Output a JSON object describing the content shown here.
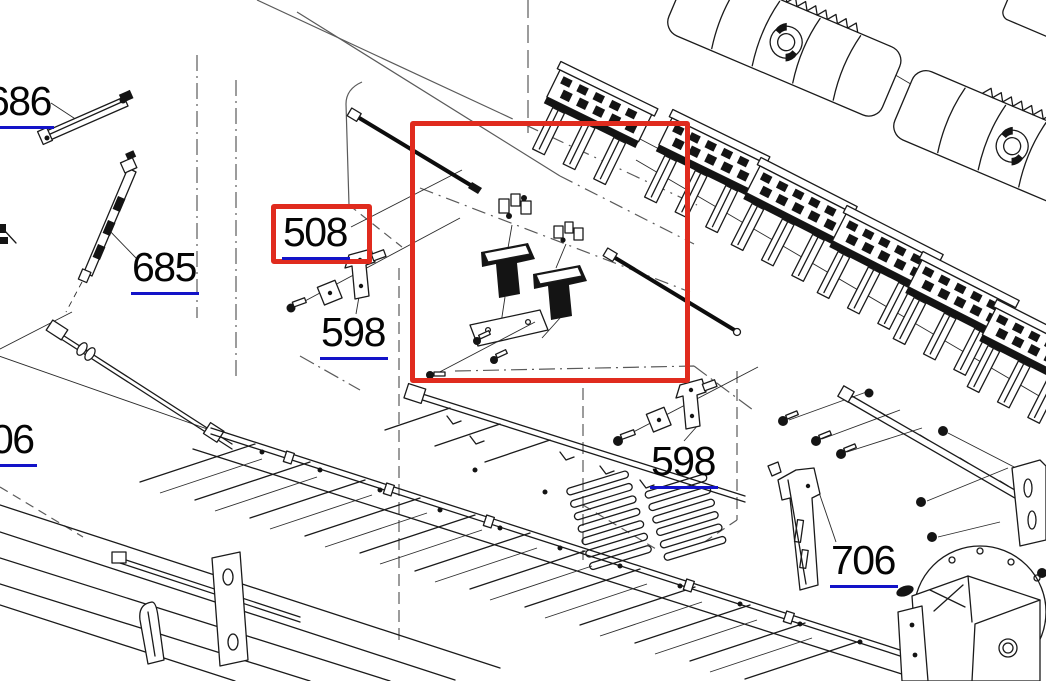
{
  "title": "Printer exploded parts diagram",
  "labels": {
    "l686": {
      "text": "686",
      "underlined": true,
      "clipped_left": true
    },
    "l685": {
      "text": "685",
      "underlined": true
    },
    "l508": {
      "text": "508",
      "underlined": true,
      "boxed": true
    },
    "l598a": {
      "text": "598",
      "underlined": true
    },
    "l06": {
      "text": "06",
      "underlined": true,
      "clipped_left": true
    },
    "l598b": {
      "text": "598",
      "underlined": true
    },
    "l706": {
      "text": "706",
      "underlined": true
    }
  },
  "highlights": {
    "region_box": {
      "x": 410,
      "y": 121,
      "width": 280,
      "height": 262,
      "purpose": "highlighted part region"
    },
    "label_box_508": {
      "x": 271,
      "y": 204,
      "width": 101,
      "height": 60,
      "purpose": "highlighted part number"
    }
  },
  "colors": {
    "background": "#ffffff",
    "line": "#1a1a1a",
    "phantom": "#5a5a5a",
    "highlight_red": "#e02b1e",
    "underline_blue": "#1313c8",
    "label_text": "#050505"
  },
  "drawn_parts": [
    "link-rod-686",
    "telescopic-rod-685",
    "carriage-shaft",
    "clamp-screw-assembly-598-left",
    "clamp-screw-assembly-598-right",
    "rod-and-bracket-group-508",
    "star-wheel-holder-row",
    "paper-guide-panels",
    "support-bracket-706",
    "mount-rail-706",
    "chassis-base-assembly",
    "louver-vent-panel",
    "fan-housing-disc"
  ]
}
